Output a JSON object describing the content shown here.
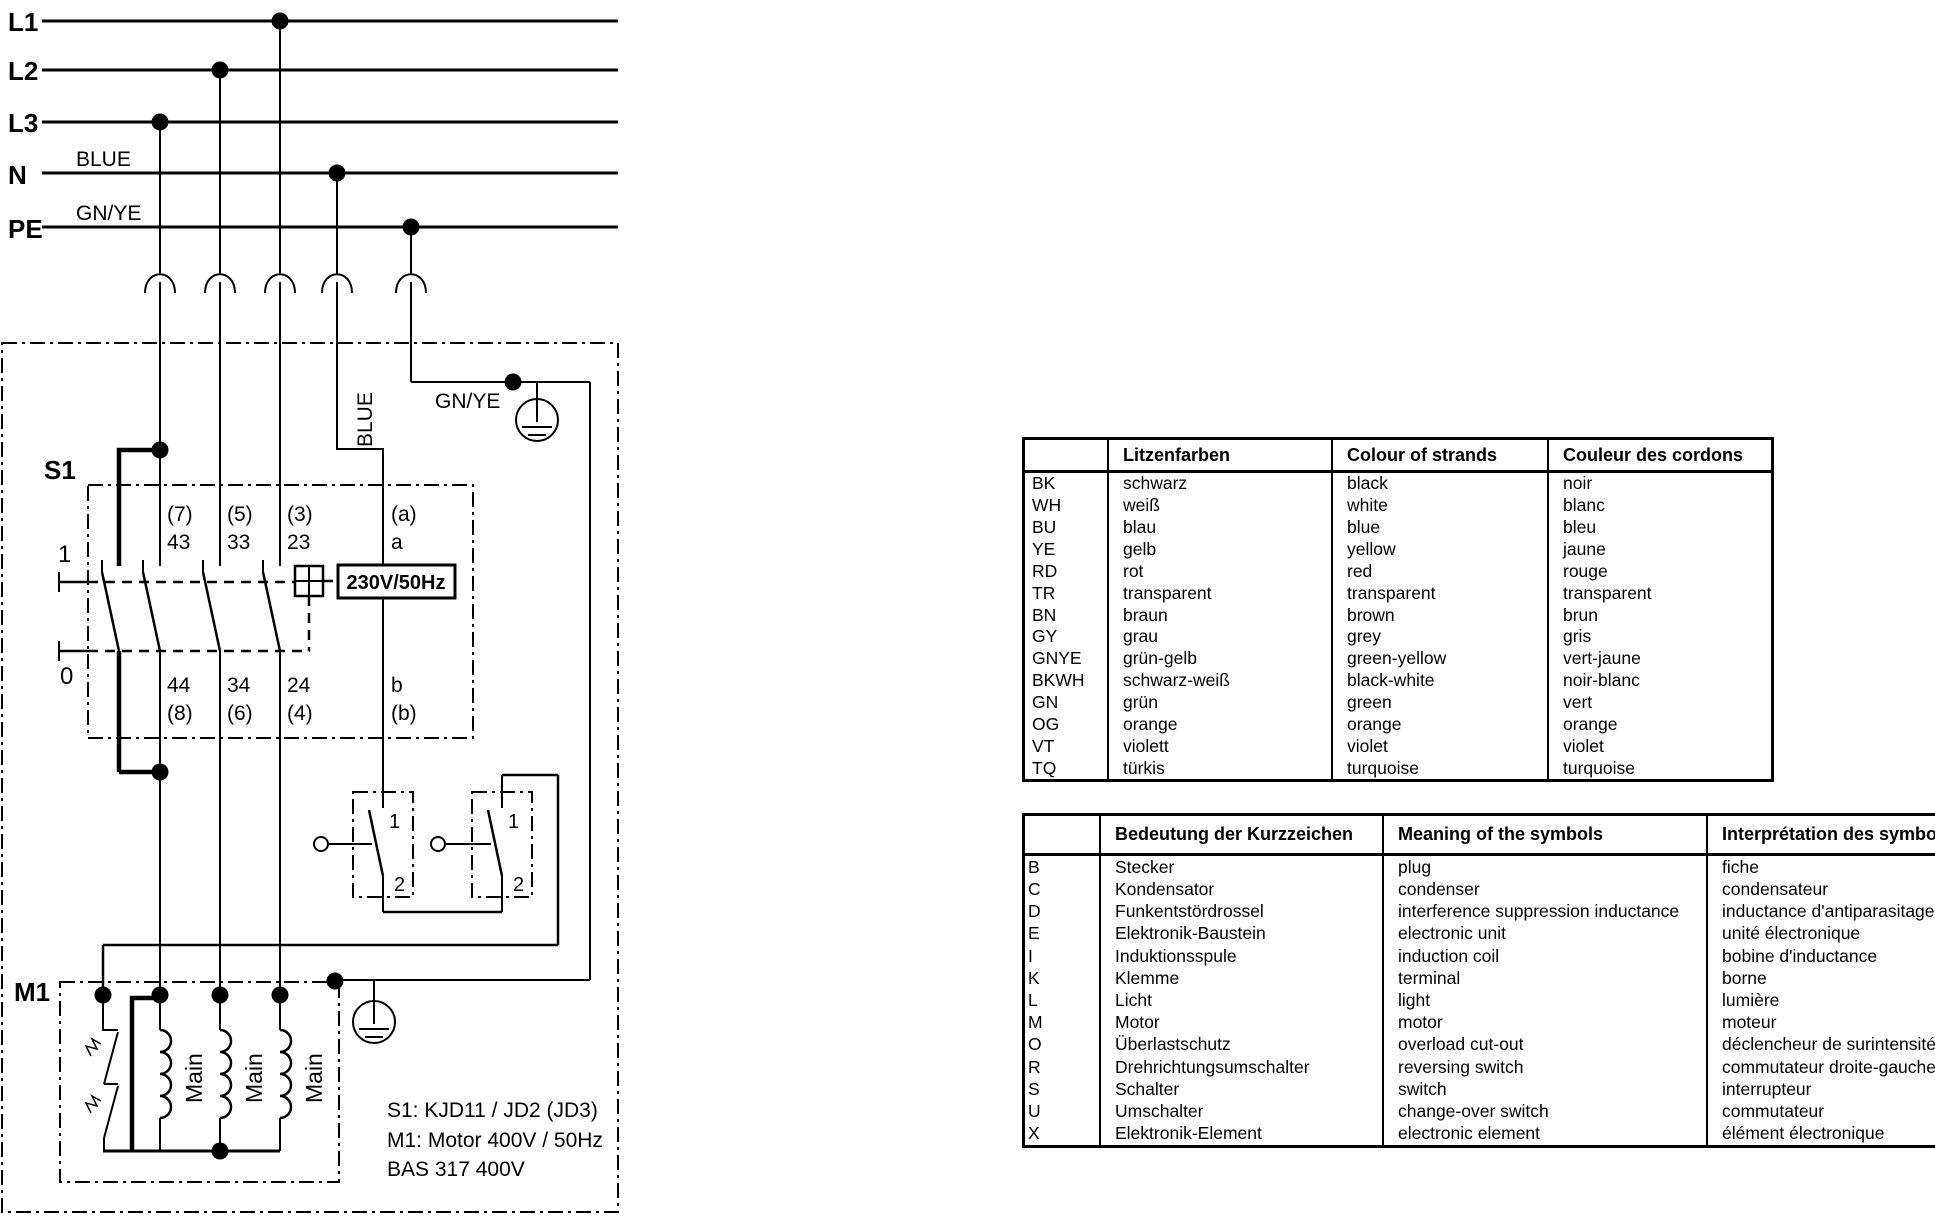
{
  "colors": {
    "ink": "#000000",
    "paper": "#ffffff"
  },
  "schematic": {
    "rails": [
      {
        "label": "L1"
      },
      {
        "label": "L2"
      },
      {
        "label": "L3"
      },
      {
        "label": "N"
      },
      {
        "label": "PE"
      }
    ],
    "wire_labels": {
      "n_rail": "BLUE",
      "pe_rail": "GN/YE",
      "blue_vertical": "BLUE",
      "gnye_inner": "GN/YE"
    },
    "s1": {
      "label": "S1",
      "position_on": "1",
      "position_off": "0",
      "coil_label": "230V/50Hz",
      "contacts": [
        {
          "top_pin": "(7)",
          "top_num": "43",
          "bottom_num": "44",
          "bottom_pin": "(8)"
        },
        {
          "top_pin": "(5)",
          "top_num": "33",
          "bottom_num": "34",
          "bottom_pin": "(6)"
        },
        {
          "top_pin": "(3)",
          "top_num": "23",
          "bottom_num": "24",
          "bottom_pin": "(4)"
        },
        {
          "top_pin": "(a)",
          "top_num": "a",
          "bottom_num": "b",
          "bottom_pin": "(b)"
        }
      ]
    },
    "aux_switches": [
      {
        "top_terminal": "1",
        "bottom_terminal": "2"
      },
      {
        "top_terminal": "1",
        "bottom_terminal": "2"
      }
    ],
    "motor": {
      "label": "M1",
      "winding_labels": [
        "Main",
        "Main",
        "Main"
      ]
    },
    "notes": [
      "S1: KJD11 / JD2 (JD3)",
      "M1: Motor 400V / 50Hz",
      "BAS 317 400V"
    ]
  },
  "color_table": {
    "headers": [
      "",
      "Litzenfarben",
      "Colour of strands",
      "Couleur des cordons"
    ],
    "rows": [
      [
        "BK",
        "schwarz",
        "black",
        "noir"
      ],
      [
        "WH",
        "weiß",
        "white",
        "blanc"
      ],
      [
        "BU",
        "blau",
        "blue",
        "bleu"
      ],
      [
        "YE",
        "gelb",
        "yellow",
        "jaune"
      ],
      [
        "RD",
        "rot",
        "red",
        "rouge"
      ],
      [
        "TR",
        "transparent",
        "transparent",
        "transparent"
      ],
      [
        "BN",
        "braun",
        "brown",
        "brun"
      ],
      [
        "GY",
        "grau",
        "grey",
        "gris"
      ],
      [
        "GNYE",
        "grün-gelb",
        "green-yellow",
        "vert-jaune"
      ],
      [
        "BKWH",
        "schwarz-weiß",
        "black-white",
        "noir-blanc"
      ],
      [
        "GN",
        "grün",
        "green",
        "vert"
      ],
      [
        "OG",
        "orange",
        "orange",
        "orange"
      ],
      [
        "VT",
        "violett",
        "violet",
        "violet"
      ],
      [
        "TQ",
        "türkis",
        "turquoise",
        "turquoise"
      ]
    ]
  },
  "symbol_table": {
    "headers": [
      "",
      "Bedeutung der Kurzzeichen",
      "Meaning of the symbols",
      "Interprétation des symboles"
    ],
    "rows": [
      [
        "B",
        "Stecker",
        "plug",
        "fiche"
      ],
      [
        "C",
        "Kondensator",
        "condenser",
        "condensateur"
      ],
      [
        "D",
        "Funkentstördrossel",
        "interference suppression inductance",
        "inductance d'antiparasitage"
      ],
      [
        "E",
        "Elektronik-Baustein",
        "electronic unit",
        "unité électronique"
      ],
      [
        "I",
        "Induktionsspule",
        "induction coil",
        "bobine d'inductance"
      ],
      [
        "K",
        "Klemme",
        "terminal",
        "borne"
      ],
      [
        "L",
        "Licht",
        "light",
        "lumière"
      ],
      [
        "M",
        "Motor",
        "motor",
        "moteur"
      ],
      [
        "O",
        "Überlastschutz",
        "overload cut-out",
        "déclencheur de surintensité"
      ],
      [
        "R",
        "Drehrichtungsumschalter",
        "reversing switch",
        "commutateur droite-gauche"
      ],
      [
        "S",
        "Schalter",
        "switch",
        "interrupteur"
      ],
      [
        "U",
        "Umschalter",
        "change-over switch",
        "commutateur"
      ],
      [
        "X",
        "Elektronik-Element",
        "electronic element",
        "élément électronique"
      ]
    ]
  }
}
